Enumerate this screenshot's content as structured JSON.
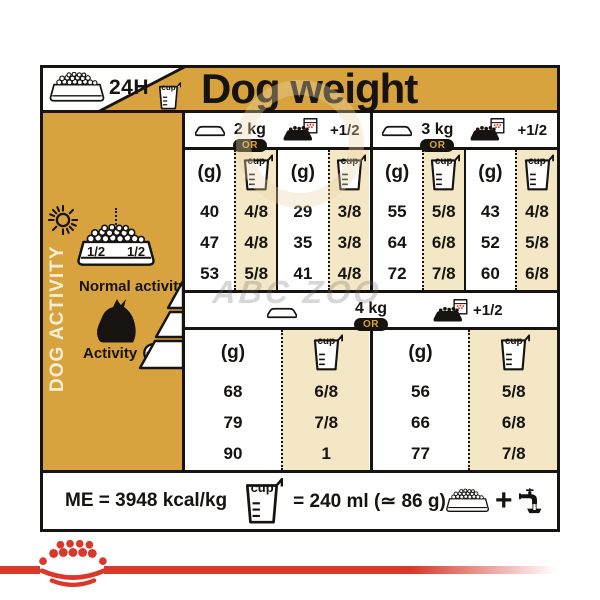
{
  "header": {
    "title": "Dog weight",
    "per_day_label": "24H"
  },
  "icons": {
    "cup_label": "cup"
  },
  "sidebar": {
    "title": "DOG ACTIVITY",
    "bowl_half_left": "1/2",
    "bowl_half_right": "1/2",
    "normal_activity_label": "Normal activity",
    "activity_label": "Activity"
  },
  "table": {
    "or_label": "OR",
    "plus_half_label": "+1/2",
    "gram_unit": "(g)",
    "top_groups": [
      {
        "weight": "2 kg",
        "dry_g": [
          "40",
          "47",
          "53"
        ],
        "dry_cup": [
          "4/8",
          "4/8",
          "5/8"
        ],
        "mix_g": [
          "29",
          "35",
          "41"
        ],
        "mix_cup": [
          "3/8",
          "3/8",
          "4/8"
        ]
      },
      {
        "weight": "3 kg",
        "dry_g": [
          "55",
          "64",
          "72"
        ],
        "dry_cup": [
          "5/8",
          "6/8",
          "7/8"
        ],
        "mix_g": [
          "43",
          "52",
          "60"
        ],
        "mix_cup": [
          "4/8",
          "5/8",
          "6/8"
        ]
      }
    ],
    "bottom_group": {
      "weight": "4 kg",
      "dry_g": [
        "68",
        "79",
        "90"
      ],
      "dry_cup": [
        "6/8",
        "7/8",
        "1"
      ],
      "mix_g": [
        "56",
        "66",
        "77"
      ],
      "mix_cup": [
        "5/8",
        "6/8",
        "7/8"
      ]
    }
  },
  "footer": {
    "me_label": "ME = 3948 kcal/kg",
    "cup_equivalence": "= 240 ml (≃ 86 g)",
    "plus": "+"
  },
  "watermark": {
    "text": "ABC ZOO"
  },
  "colors": {
    "gold": "#D8A33F",
    "beige": "#F4E7C5",
    "ink": "#161310",
    "red": "#D9382B"
  },
  "chart_data": {
    "type": "table",
    "title": "Dog weight",
    "columns": [
      "grams per day (g)",
      "cups per day"
    ],
    "activity_rows": [
      "normal activity",
      "medium activity",
      "activity +"
    ],
    "groups": [
      {
        "dog_weight_kg": 2,
        "ration": "dry only",
        "grams": [
          40,
          47,
          53
        ],
        "cups": [
          "4/8",
          "4/8",
          "5/8"
        ]
      },
      {
        "dog_weight_kg": 2,
        "ration": "dry + 1/2 pouch",
        "grams": [
          29,
          35,
          41
        ],
        "cups": [
          "3/8",
          "3/8",
          "4/8"
        ]
      },
      {
        "dog_weight_kg": 3,
        "ration": "dry only",
        "grams": [
          55,
          64,
          72
        ],
        "cups": [
          "5/8",
          "6/8",
          "7/8"
        ]
      },
      {
        "dog_weight_kg": 3,
        "ration": "dry + 1/2 pouch",
        "grams": [
          43,
          52,
          60
        ],
        "cups": [
          "4/8",
          "5/8",
          "6/8"
        ]
      },
      {
        "dog_weight_kg": 4,
        "ration": "dry only",
        "grams": [
          68,
          79,
          90
        ],
        "cups": [
          "6/8",
          "7/8",
          "1"
        ]
      },
      {
        "dog_weight_kg": 4,
        "ration": "dry + 1/2 pouch",
        "grams": [
          56,
          66,
          77
        ],
        "cups": [
          "5/8",
          "6/8",
          "7/8"
        ]
      }
    ],
    "notes": {
      "me": "ME = 3948 kcal/kg",
      "cup": "1 cup = 240 ml (≃ 86 g)",
      "period": "24H"
    }
  }
}
